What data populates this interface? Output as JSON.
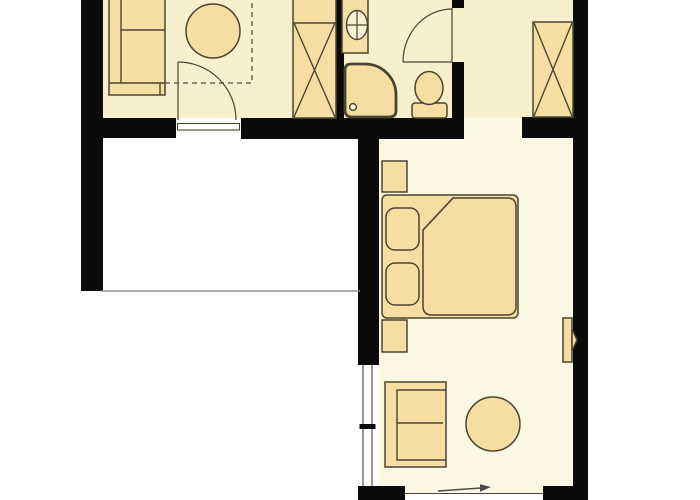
{
  "title": "apartment-floor-plan",
  "colors": {
    "wall": "#0b0b0b",
    "floor_top": "#f8f0cd",
    "floor_bedroom": "#fbf7e3",
    "furniture": "#f5dea1",
    "fixture_light": "#f9f1d4",
    "outline": "#4b4433",
    "dashed": "#55503f",
    "thin_line": "#8f8f8f",
    "arrow": "#4a4a45"
  },
  "rooms": [
    {
      "name": "living-area",
      "contents": [
        "sofa",
        "round-table",
        "wardrobe-x",
        "swing-door",
        "dashed-ceiling-line",
        "door-threshold"
      ]
    },
    {
      "name": "bathroom",
      "contents": [
        "washbasin-counter",
        "washbasin",
        "shower",
        "shower-drain",
        "toilet",
        "swing-door"
      ]
    },
    {
      "name": "hallway",
      "contents": [
        "wardrobe-x"
      ]
    },
    {
      "name": "bedroom",
      "contents": [
        "nightstand",
        "double-bed",
        "pillow",
        "pillow",
        "duvet-with-fold",
        "nightstand",
        "wall-tv",
        "sofa",
        "round-table",
        "window",
        "entrance-arrow",
        "wall-opening"
      ]
    }
  ],
  "annotations": {
    "entrance_arrow_direction": "right"
  }
}
